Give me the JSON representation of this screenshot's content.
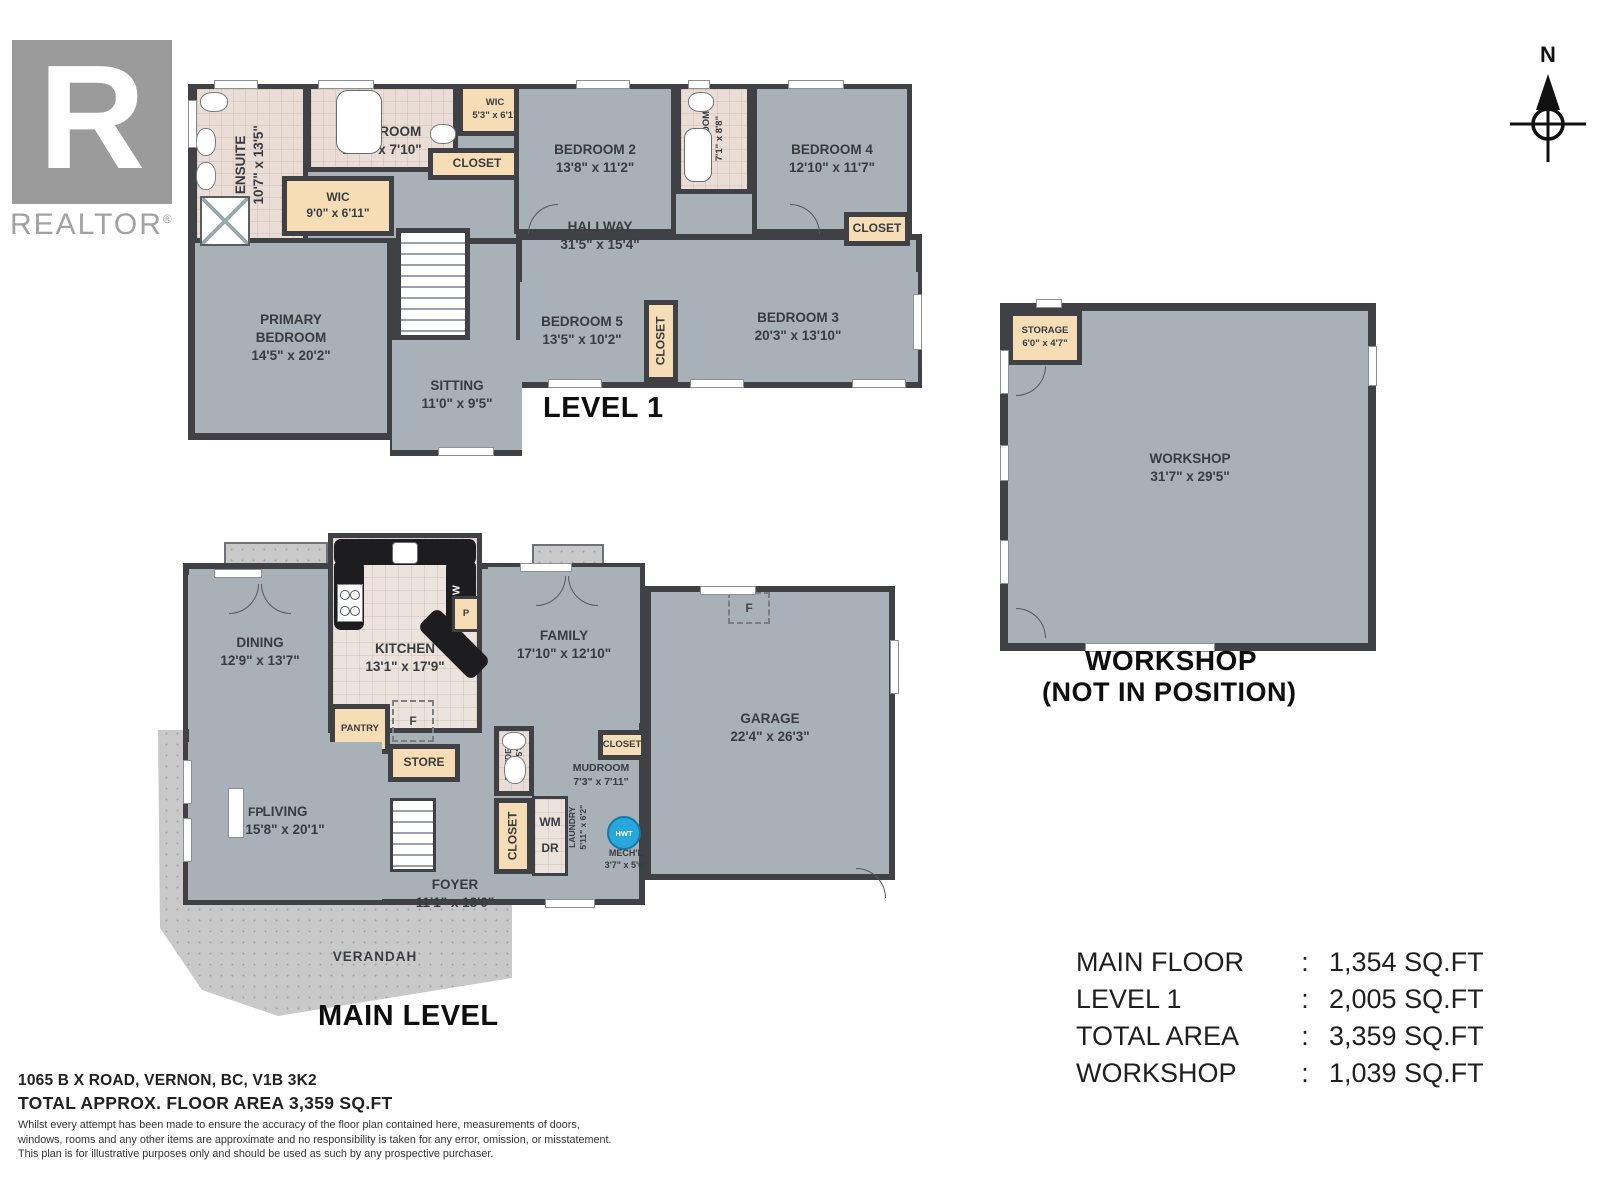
{
  "logo": {
    "letter": "R",
    "brand": "REALTOR",
    "registered": "®"
  },
  "compass": {
    "north_label": "N"
  },
  "level1": {
    "title": "LEVEL 1",
    "rooms": {
      "ensuite": {
        "name": "ENSUITE",
        "dims": "10'7\" x 13'5\""
      },
      "bathroom": {
        "name": "BATHROOM",
        "dims": "12'7\" x 7'10\""
      },
      "wic_small": {
        "name": "WIC",
        "dims": "5'3\" x 6'1\""
      },
      "closet_top": {
        "name": "CLOSET"
      },
      "wic": {
        "name": "WIC",
        "dims": "9'0\" x 6'11\""
      },
      "bedroom2": {
        "name": "BEDROOM 2",
        "dims": "13'8\" x 11'2\""
      },
      "bathroom_small": {
        "name": "BATHROOM",
        "dims": "7'1\" x 8'8\""
      },
      "bedroom4": {
        "name": "BEDROOM 4",
        "dims": "12'10\" x 11'7\""
      },
      "closet_right": {
        "name": "CLOSET"
      },
      "hallway": {
        "name": "HALLWAY",
        "dims": "31'5\" x 15'4\""
      },
      "primary_bedroom": {
        "name": "PRIMARY BEDROOM",
        "dims": "14'5\" x 20'2\""
      },
      "sitting": {
        "name": "SITTING",
        "dims": "11'0\" x 9'5\""
      },
      "bedroom5": {
        "name": "BEDROOM 5",
        "dims": "13'5\" x 10'2\""
      },
      "closet_mid": {
        "name": "CLOSET"
      },
      "bedroom3": {
        "name": "BEDROOM 3",
        "dims": "20'3\" x 13'10\""
      }
    }
  },
  "main_level": {
    "title": "MAIN LEVEL",
    "rooms": {
      "dining": {
        "name": "DINING",
        "dims": "12'9\" x 13'7\""
      },
      "kitchen": {
        "name": "KITCHEN",
        "dims": "13'1\" x 17'9\""
      },
      "dw": {
        "name": "DW"
      },
      "pantry_p": {
        "name": "P"
      },
      "pantry": {
        "name": "PANTRY"
      },
      "fridge": {
        "name": "F"
      },
      "store": {
        "name": "STORE"
      },
      "family": {
        "name": "FAMILY",
        "dims": "17'10\" x 12'10\""
      },
      "garage": {
        "name": "GARAGE",
        "dims": "22'4\" x 26'3\""
      },
      "furnace": {
        "name": "F"
      },
      "powder": {
        "name": "POWDER",
        "dims": "4'7\" x 5'8\""
      },
      "mud_closet": {
        "name": "CLOSET"
      },
      "mudroom": {
        "name": "MUDROOM",
        "dims": "7'3\" x 7'11\""
      },
      "laundry_closet": {
        "name": "CLOSET"
      },
      "washer": {
        "name": "WM"
      },
      "dryer": {
        "name": "DR"
      },
      "laundry": {
        "name": "LAUNDRY",
        "dims": "5'11\" x 6'2\""
      },
      "hwt": {
        "name": "HWT"
      },
      "mech": {
        "name": "MECH'L",
        "dims": "3'7\" x 5'0\""
      },
      "living": {
        "name": "LIVING",
        "dims": "15'8\" x 20'1\""
      },
      "fireplace": {
        "name": "FP"
      },
      "foyer": {
        "name": "FOYER",
        "dims": "11'1\" x 18'0\""
      },
      "verandah": {
        "name": "VERANDAH"
      }
    }
  },
  "workshop_plan": {
    "caption_line1": "WORKSHOP",
    "caption_line2": "(NOT IN POSITION)",
    "rooms": {
      "workshop": {
        "name": "WORKSHOP",
        "dims": "31'7\" x 29'5\""
      },
      "storage": {
        "name": "STORAGE",
        "dims": "6'0\" x 4'7\""
      }
    }
  },
  "summary": {
    "colon": ":",
    "rows": [
      {
        "label": "MAIN FLOOR",
        "value": "1,354 SQ.FT"
      },
      {
        "label": "LEVEL 1",
        "value": "2,005 SQ.FT"
      },
      {
        "label": "TOTAL AREA",
        "value": "3,359 SQ.FT"
      },
      {
        "label": "WORKSHOP",
        "value": "1,039 SQ.FT"
      }
    ]
  },
  "footer": {
    "address": "1065 B X ROAD, VERNON, BC, V1B 3K2",
    "area_line": "TOTAL APPROX. FLOOR AREA 3,359 SQ.FT",
    "disclaimer_line1": "Whilst every attempt has been made to ensure the accuracy of the floor plan contained here, measurements of doors,",
    "disclaimer_line2": "windows, rooms and any other items are approximate and no responsibility is taken for any error, omission, or misstatement.",
    "disclaimer_line3": "This plan is for illustrative purposes only and should be used as such by any prospective purchaser."
  }
}
